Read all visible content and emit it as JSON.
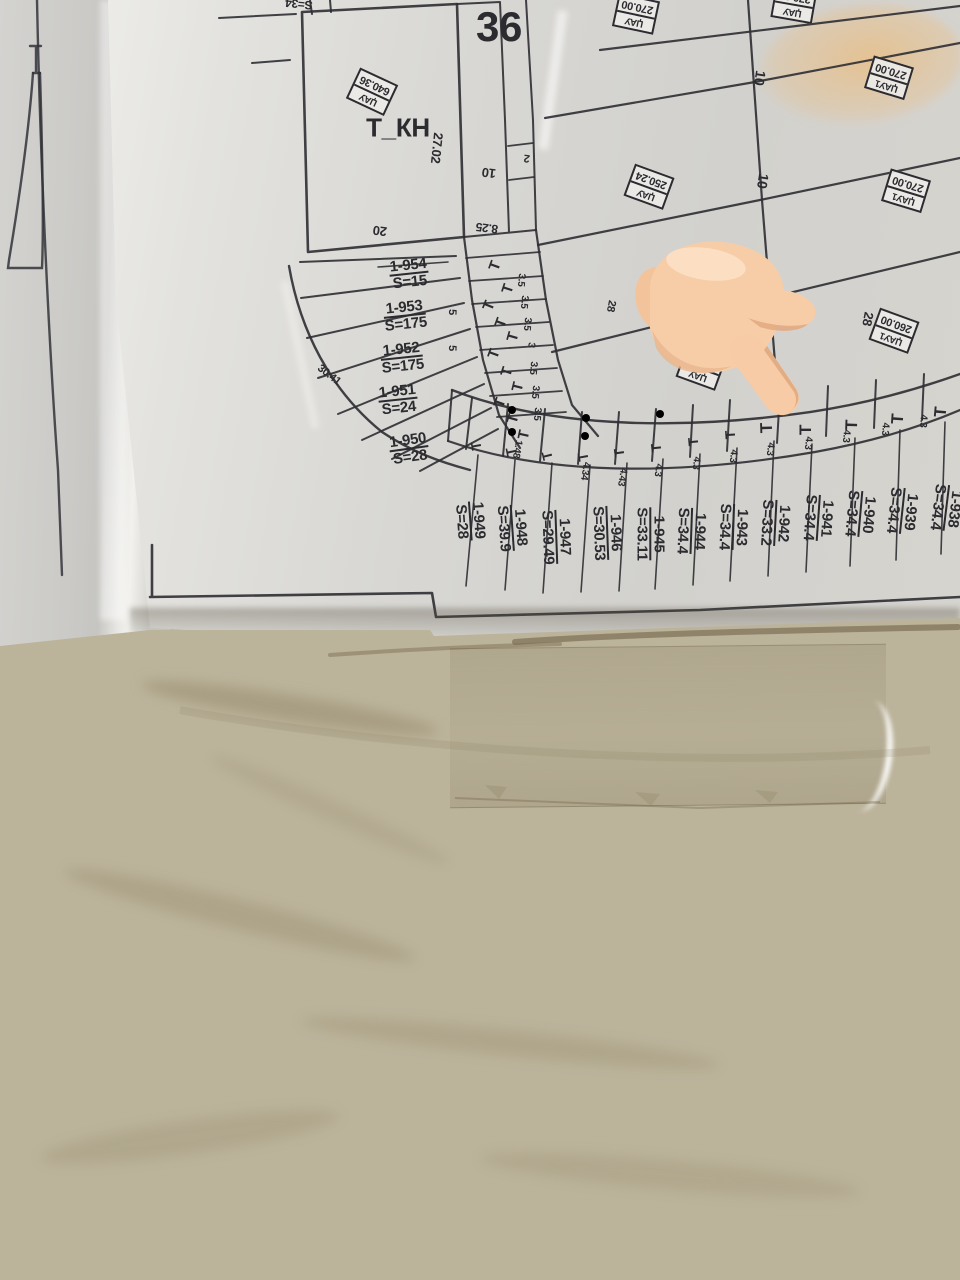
{
  "scene": {
    "description": "Photograph of a cadastral / allotment plan sheet in a plastic sleeve lying on a beige marble floor, with a pointing-hand emoji overlaid",
    "overlay_icon": "backhand-index-pointing-down-emoji"
  },
  "colors": {
    "paper": "#d8d7d3",
    "ink": "#2e2e33",
    "floor": "#bbb39a",
    "crayon_mark": "#eeb973",
    "hand_skin": "#f7cda8",
    "hand_shade": "#e2a87e"
  },
  "map": {
    "block_number": "36",
    "tkn_parcel_label": "Т_КН",
    "t_symbol": "Т",
    "stamps": [
      {
        "label": "ЏАУ",
        "value": "640.36",
        "x": 372,
        "y": 92,
        "rot": 205
      },
      {
        "label": "ЏАУ",
        "value": "270.00",
        "x": 636,
        "y": 14,
        "rot": 192
      },
      {
        "label": "ЏАУ",
        "value": "270.00",
        "x": 794,
        "y": 4,
        "rot": 190
      },
      {
        "label": "ЏАУ1",
        "value": "270.00",
        "x": 889,
        "y": 78,
        "rot": 197
      },
      {
        "label": "ЏАУ",
        "value": "250.24",
        "x": 649,
        "y": 187,
        "rot": 200
      },
      {
        "label": "ЏАУ1",
        "value": "270.00",
        "x": 906,
        "y": 191,
        "rot": 197
      },
      {
        "label": "ЏАУ1",
        "value": "282.50",
        "x": 669,
        "y": 298,
        "rot": 197
      },
      {
        "label": "ЏАУ",
        "value": "273.50",
        "x": 701,
        "y": 368,
        "rot": 200
      },
      {
        "label": "ЏАУ1",
        "value": "260.00",
        "x": 894,
        "y": 331,
        "rot": 200
      }
    ],
    "fan_parcels": [
      {
        "id": "1-954",
        "area": "S=15",
        "x": 409,
        "y": 274,
        "rot": -6
      },
      {
        "id": "1-953",
        "area": "S=175",
        "x": 405,
        "y": 316,
        "rot": -6
      },
      {
        "id": "1-952",
        "area": "S=175",
        "x": 402,
        "y": 358,
        "rot": -6
      },
      {
        "id": "1-951",
        "area": "S=24",
        "x": 398,
        "y": 400,
        "rot": -6
      },
      {
        "id": "1-950",
        "area": "S=28",
        "x": 409,
        "y": 449,
        "rot": -8
      }
    ],
    "strip_parcels": [
      {
        "id": "1-949",
        "area": "S=28",
        "x": 470,
        "y": 521,
        "rot": 86
      },
      {
        "id": "1-948",
        "area": "S=39.9",
        "x": 512,
        "y": 528,
        "rot": 86
      },
      {
        "id": "1-947",
        "area": "S=29.49",
        "x": 556,
        "y": 537,
        "rot": 88
      },
      {
        "id": "1-946",
        "area": "S=30.53",
        "x": 607,
        "y": 533,
        "rot": 88
      },
      {
        "id": "1-945",
        "area": "S=33.11",
        "x": 650,
        "y": 534,
        "rot": 90
      },
      {
        "id": "1-944",
        "area": "S=34.4",
        "x": 691,
        "y": 531,
        "rot": 92
      },
      {
        "id": "1-943",
        "area": "S=34.4",
        "x": 733,
        "y": 527,
        "rot": 92
      },
      {
        "id": "1-942",
        "area": "S=33.2",
        "x": 775,
        "y": 523,
        "rot": 93
      },
      {
        "id": "1-941",
        "area": "S=34.4",
        "x": 818,
        "y": 518,
        "rot": 94
      },
      {
        "id": "1-940",
        "area": "S=34.4",
        "x": 860,
        "y": 514,
        "rot": 95
      },
      {
        "id": "1-939",
        "area": "S=34.4",
        "x": 902,
        "y": 511,
        "rot": 96
      },
      {
        "id": "1-938",
        "area": "S=34.4",
        "x": 946,
        "y": 508,
        "rot": 97
      }
    ],
    "dimensions": [
      {
        "t": "27.02",
        "x": 437,
        "y": 148,
        "rot": 96,
        "fs": 13
      },
      {
        "t": "20",
        "x": 380,
        "y": 231,
        "rot": 187,
        "fs": 13
      },
      {
        "t": "8.25",
        "x": 487,
        "y": 228,
        "rot": 187,
        "fs": 12
      },
      {
        "t": "10",
        "x": 489,
        "y": 173,
        "rot": 187,
        "fs": 13
      },
      {
        "t": "2",
        "x": 527,
        "y": 158,
        "rot": 187,
        "fs": 11
      },
      {
        "t": "10",
        "x": 760,
        "y": 78,
        "rot": 99,
        "fs": 14
      },
      {
        "t": "10",
        "x": 763,
        "y": 181,
        "rot": 99,
        "fs": 14
      },
      {
        "t": "10",
        "x": 758,
        "y": 266,
        "rot": 99,
        "fs": 14
      },
      {
        "t": "28",
        "x": 868,
        "y": 319,
        "rot": 101,
        "fs": 13
      },
      {
        "t": "28",
        "x": 611,
        "y": 306,
        "rot": 101,
        "fs": 11
      },
      {
        "t": "30.41",
        "x": 329,
        "y": 375,
        "rot": 38,
        "fs": 11
      },
      {
        "t": "5",
        "x": 452,
        "y": 312,
        "rot": 92,
        "fs": 11
      },
      {
        "t": "5",
        "x": 452,
        "y": 348,
        "rot": 92,
        "fs": 11
      },
      {
        "t": "S=34",
        "x": 299,
        "y": 4,
        "rot": 186,
        "fs": 12
      },
      {
        "t": "3.5",
        "x": 521,
        "y": 280,
        "rot": 95,
        "fs": 10
      },
      {
        "t": "3.5",
        "x": 524,
        "y": 302,
        "rot": 95,
        "fs": 10
      },
      {
        "t": "3.5",
        "x": 527,
        "y": 324,
        "rot": 95,
        "fs": 10
      },
      {
        "t": "3",
        "x": 531,
        "y": 345,
        "rot": 95,
        "fs": 10
      },
      {
        "t": "3.5",
        "x": 533,
        "y": 368,
        "rot": 95,
        "fs": 10
      },
      {
        "t": "3.5",
        "x": 535,
        "y": 392,
        "rot": 95,
        "fs": 10
      },
      {
        "t": "3.5",
        "x": 537,
        "y": 414,
        "rot": 95,
        "fs": 10
      },
      {
        "t": "1.48",
        "x": 517,
        "y": 449,
        "rot": 100,
        "fs": 10
      },
      {
        "t": "4.34",
        "x": 585,
        "y": 471,
        "rot": 99,
        "fs": 10
      },
      {
        "t": "4.43",
        "x": 622,
        "y": 477,
        "rot": 99,
        "fs": 10
      },
      {
        "t": "4.3",
        "x": 658,
        "y": 470,
        "rot": 98,
        "fs": 10
      },
      {
        "t": "4.3",
        "x": 696,
        "y": 463,
        "rot": 97,
        "fs": 10
      },
      {
        "t": "4.3",
        "x": 733,
        "y": 456,
        "rot": 96,
        "fs": 10
      },
      {
        "t": "4.3",
        "x": 770,
        "y": 449,
        "rot": 96,
        "fs": 10
      },
      {
        "t": "4.3",
        "x": 808,
        "y": 443,
        "rot": 95,
        "fs": 10
      },
      {
        "t": "4.3",
        "x": 846,
        "y": 436,
        "rot": 95,
        "fs": 10
      },
      {
        "t": "4.3",
        "x": 885,
        "y": 429,
        "rot": 94,
        "fs": 10
      },
      {
        "t": "4.3",
        "x": 923,
        "y": 421,
        "rot": 94,
        "fs": 10
      }
    ],
    "t_marks": [
      {
        "x": 495,
        "y": 266,
        "rot": -70,
        "fs": 15
      },
      {
        "x": 508,
        "y": 289,
        "rot": -72,
        "fs": 15
      },
      {
        "x": 489,
        "y": 306,
        "rot": -68,
        "fs": 15
      },
      {
        "x": 501,
        "y": 323,
        "rot": -70,
        "fs": 15
      },
      {
        "x": 513,
        "y": 337,
        "rot": -74,
        "fs": 15
      },
      {
        "x": 494,
        "y": 354,
        "rot": -70,
        "fs": 15
      },
      {
        "x": 507,
        "y": 372,
        "rot": -72,
        "fs": 15
      },
      {
        "x": 518,
        "y": 387,
        "rot": -76,
        "fs": 15
      },
      {
        "x": 500,
        "y": 403,
        "rot": -70,
        "fs": 15
      },
      {
        "x": 513,
        "y": 419,
        "rot": -74,
        "fs": 15
      },
      {
        "x": 524,
        "y": 435,
        "rot": -78,
        "fs": 15
      },
      {
        "x": 476,
        "y": 446,
        "rot": -100,
        "fs": 14
      },
      {
        "x": 511,
        "y": 452,
        "rot": -102,
        "fs": 14
      },
      {
        "x": 547,
        "y": 456,
        "rot": -104,
        "fs": 14
      },
      {
        "x": 583,
        "y": 457,
        "rot": -100,
        "fs": 14
      },
      {
        "x": 619,
        "y": 453,
        "rot": -98,
        "fs": 14
      },
      {
        "x": 656,
        "y": 448,
        "rot": -96,
        "fs": 14
      },
      {
        "x": 693,
        "y": 442,
        "rot": -95,
        "fs": 14
      },
      {
        "x": 730,
        "y": 435,
        "rot": -94,
        "fs": 14
      },
      {
        "x": 767,
        "y": 428,
        "rot": -92,
        "fs": 17
      },
      {
        "x": 806,
        "y": 430,
        "rot": -90,
        "fs": 17
      },
      {
        "x": 852,
        "y": 425,
        "rot": -88,
        "fs": 17
      },
      {
        "x": 898,
        "y": 419,
        "rot": -86,
        "fs": 17
      },
      {
        "x": 941,
        "y": 412,
        "rot": -85,
        "fs": 17
      }
    ]
  }
}
